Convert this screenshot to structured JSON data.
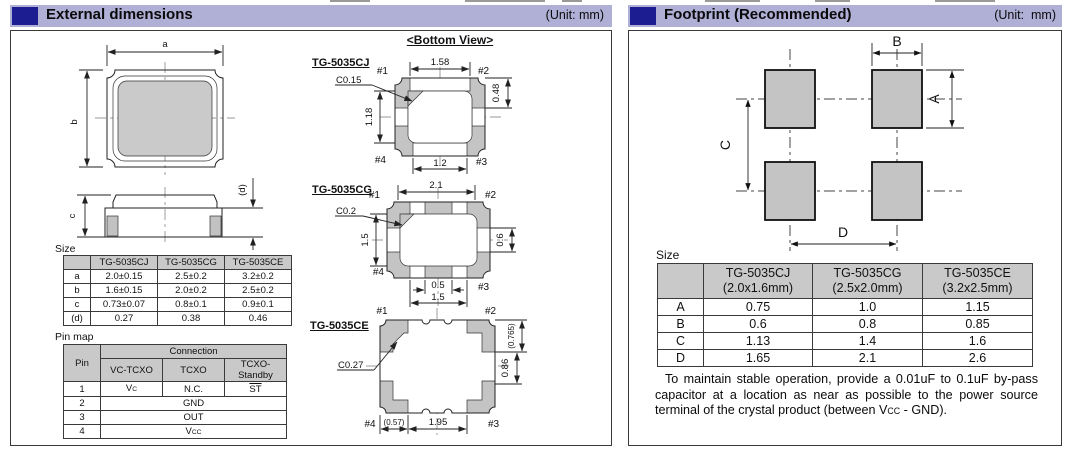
{
  "headers": {
    "left": {
      "title": "External dimensions",
      "unit": "(Unit: mm)"
    },
    "right": {
      "title": "Footprint (Recommended)",
      "unit": "(Unit:  mm)"
    }
  },
  "external": {
    "bottom_view_title": "<Bottom View>",
    "top_view": {
      "a": "a",
      "b": "b",
      "c": "c",
      "d": "(d)"
    },
    "cj": {
      "name": "TG-5035CJ",
      "chamfer": "C0.15",
      "dim_top": "1.58",
      "dim_right": "0.48",
      "dim_left": "1.18",
      "dim_bottom": "1.2",
      "pin1": "#1",
      "pin2": "#2",
      "pin3": "#3",
      "pin4": "#4"
    },
    "cg": {
      "name": "TG-5035CG",
      "chamfer": "C0.2",
      "dim_top": "2.1",
      "dim_left": "1.5",
      "dim_right": "0.6",
      "dim_bottom_inner": "0.5",
      "dim_bottom": "1.5",
      "pin1": "#1",
      "pin2": "#2",
      "pin3": "#3",
      "pin4": "#4"
    },
    "ce": {
      "name": "TG-5035CE",
      "chamfer": "C0.27",
      "dim_right_top": "(0.765)",
      "dim_right": "0.86",
      "dim_bottom_left": "(0.57)",
      "dim_bottom": "1.95",
      "pin1": "#1",
      "pin2": "#2",
      "pin3": "#3",
      "pin4": "#4"
    },
    "size_table": {
      "label": "Size",
      "col_headers": [
        "TG-5035CJ",
        "TG-5035CG",
        "TG-5035CE"
      ],
      "rows": [
        {
          "label": "a",
          "v": [
            "2.0±0.15",
            "2.5±0.2",
            "3.2±0.2"
          ]
        },
        {
          "label": "b",
          "v": [
            "1.6±0.15",
            "2.0±0.2",
            "2.5±0.2"
          ]
        },
        {
          "label": "c",
          "v": [
            "0.73±0.07",
            "0.8±0.1",
            "0.9±0.1"
          ]
        },
        {
          "label": "(d)",
          "v": [
            "0.27",
            "0.38",
            "0.46"
          ]
        }
      ]
    },
    "pin_map": {
      "label": "Pin map",
      "pin_header": "Pin",
      "connection_header": "Connection",
      "mode_headers": [
        "VC-TCXO",
        "TCXO",
        "TCXO-Standby"
      ],
      "rows": [
        {
          "pin": "1",
          "vc_main": "V",
          "vc_sub": "C",
          "tcxo": "N.C.",
          "standby": "ST"
        },
        {
          "pin": "2",
          "all": "GND"
        },
        {
          "pin": "3",
          "all": "OUT"
        },
        {
          "pin": "4",
          "vcc_main": "V",
          "vcc_sub": "CC"
        }
      ]
    }
  },
  "footprint": {
    "dim_a": "A",
    "dim_b": "B",
    "dim_c": "C",
    "dim_d": "D",
    "size_table": {
      "label": "Size",
      "col_headers": [
        {
          "name": "TG-5035CJ",
          "size": "(2.0x1.6mm)"
        },
        {
          "name": "TG-5035CG",
          "size": "(2.5x2.0mm)"
        },
        {
          "name": "TG-5035CE",
          "size": "(3.2x2.5mm)"
        }
      ],
      "rows": [
        {
          "label": "A",
          "v": [
            "0.75",
            "1.0",
            "1.15"
          ]
        },
        {
          "label": "B",
          "v": [
            "0.6",
            "0.8",
            "0.85"
          ]
        },
        {
          "label": "C",
          "v": [
            "1.13",
            "1.4",
            "1.6"
          ]
        },
        {
          "label": "D",
          "v": [
            "1.65",
            "2.1",
            "2.6"
          ]
        }
      ]
    },
    "note": {
      "pre": "To maintain stable operation, provide a 0.01uF to 0.1uF by-pass capacitor at a location as near as possible to the power source terminal of the crystal product (between V",
      "sub": "CC",
      "post": " - GND)."
    }
  },
  "colors": {
    "header_bar": "#b0afd6",
    "header_square": "#1d1d92",
    "table_header_bg": "#c9c9c9",
    "pad_fill": "#c4c4c4"
  }
}
